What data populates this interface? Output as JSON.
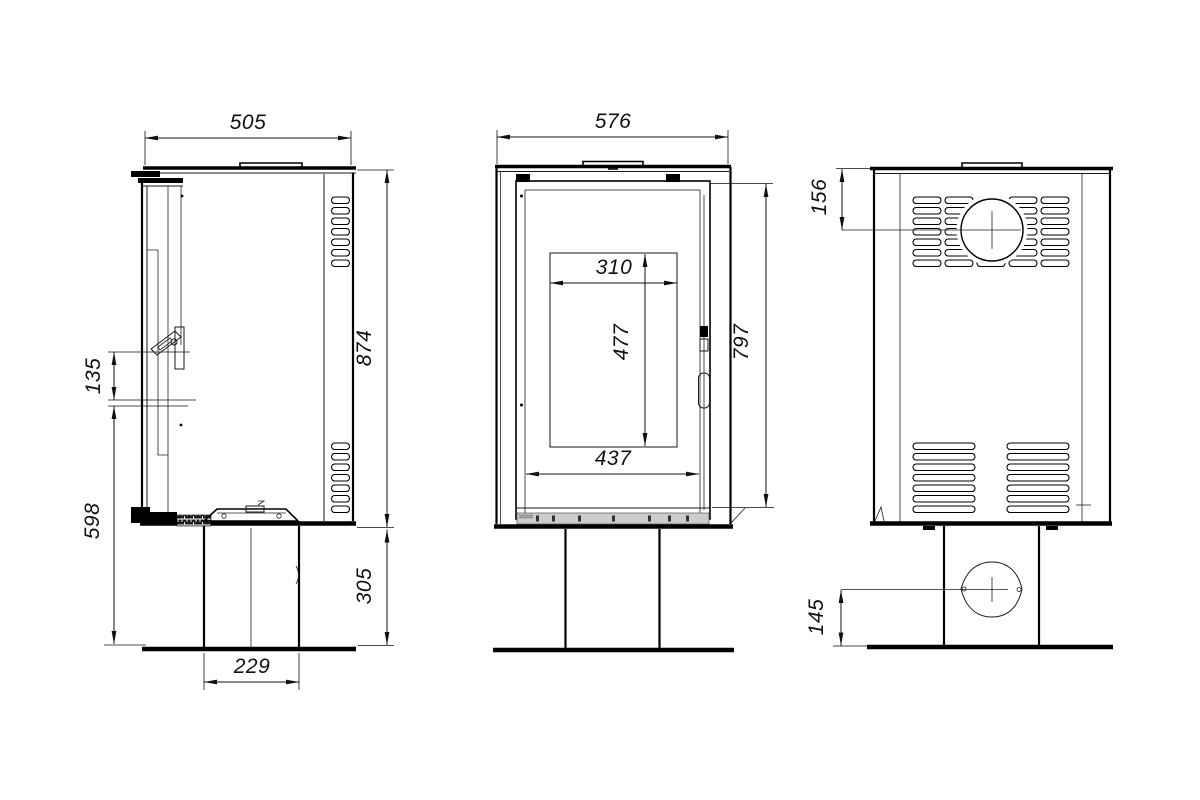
{
  "colors": {
    "ink": "#111111",
    "paper": "#ffffff",
    "base_strip": "#cccccc"
  },
  "views": {
    "side": {
      "dims": {
        "top_depth": "505",
        "body_height": "874",
        "handle_span": "135",
        "handle_to_floor": "598",
        "pedestal_height": "305",
        "pedestal_depth": "229"
      }
    },
    "front": {
      "dims": {
        "top_width": "576",
        "glass_width": "310",
        "glass_height": "477",
        "door_inner_width": "437",
        "body_height": "797"
      }
    },
    "rear": {
      "dims": {
        "flue_center_from_top": "156",
        "inlet_center_from_floor": "145"
      }
    }
  }
}
